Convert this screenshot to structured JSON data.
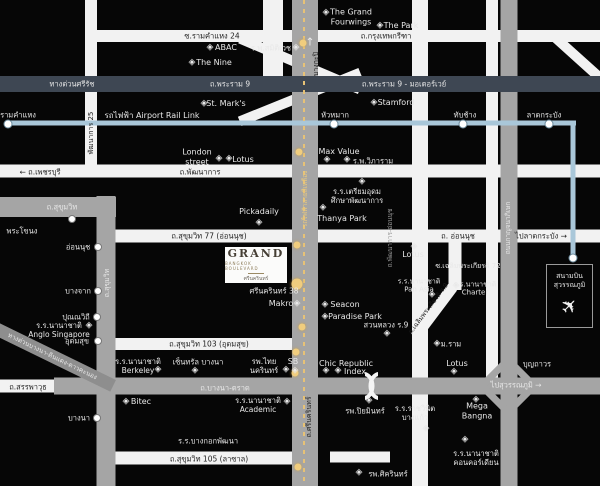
{
  "colors": {
    "background": "#060606",
    "road_white": "#f2f2f2",
    "road_gray": "#a5a5a5",
    "road_dark_expressway": "#3e4753",
    "airport_rail_link_blue": "#a9c7d9",
    "yellow_line": "#e7c276",
    "gold_station": "#f0cd7e",
    "label_white": "#e8e8e8",
    "label_dark": "#1c1c1c",
    "logo_brown": "#453e34"
  },
  "poi_glyph": "◈",
  "logo": {
    "title": "GRAND",
    "subtitle": "BANGKOK BOULEVARD",
    "thai": "ศรีนครินทร์"
  },
  "airport": {
    "name": "สนามบิน\nสุวรรณภูมิ",
    "icon": "airplane-icon"
  },
  "roads": [
    {
      "n": "road-ramkhamhaeng24-krungthepkreetha",
      "k": "white",
      "x": 344,
      "y": 36,
      "w": 512,
      "h": 12
    },
    {
      "n": "road-rama9-expressway",
      "k": "dark",
      "x": 300,
      "y": 84,
      "w": 600,
      "h": 16
    },
    {
      "n": "road-phatthanakan25",
      "k": "white",
      "x": 91,
      "y": 84,
      "w": 12,
      "h": 168
    },
    {
      "n": "road-phetchaburi-phatthanakan",
      "k": "white",
      "x": 300,
      "y": 171,
      "w": 600,
      "h": 13
    },
    {
      "n": "road-sukhumvit-horizontal",
      "k": "gray",
      "x": 58,
      "y": 207,
      "w": 116,
      "h": 20
    },
    {
      "n": "road-sukhumvit-vertical",
      "k": "gray",
      "x": 106,
      "y": 341,
      "w": 19,
      "h": 290
    },
    {
      "n": "road-onnut-sukhumvit77",
      "k": "white",
      "x": 356,
      "y": 236,
      "w": 488,
      "h": 13
    },
    {
      "n": "road-sukhumvit103",
      "k": "white",
      "x": 204,
      "y": 344,
      "w": 184,
      "h": 12
    },
    {
      "n": "road-bangna-trad",
      "k": "gray",
      "x": 327,
      "y": 386,
      "w": 546,
      "h": 17
    },
    {
      "n": "road-sanphawut",
      "k": "white",
      "x": 28,
      "y": 386,
      "w": 57,
      "h": 13
    },
    {
      "n": "road-expressway-bangna-diagonal",
      "k": "dgray",
      "x": 52,
      "y": 356,
      "w": 136,
      "h": 13,
      "r": 26
    },
    {
      "n": "road-sukhumvit105",
      "k": "white",
      "x": 204,
      "y": 458,
      "w": 184,
      "h": 13
    },
    {
      "n": "road-lasalle-east-segment",
      "k": "white",
      "x": 360,
      "y": 457,
      "w": 60,
      "h": 11
    },
    {
      "n": "road-srinakarin",
      "k": "gray",
      "x": 305,
      "y": 243,
      "w": 26,
      "h": 486
    },
    {
      "n": "road-chalermprakiat-r9-vertical",
      "k": "white",
      "x": 420,
      "y": 243,
      "w": 16,
      "h": 486
    },
    {
      "n": "road-soi-chalermprakiat72",
      "k": "white",
      "x": 455,
      "y": 266,
      "w": 13,
      "h": 48
    },
    {
      "n": "road-chalermprakiat-diagonal",
      "k": "white",
      "x": 434,
      "y": 312,
      "w": 62,
      "h": 11,
      "r": -53
    },
    {
      "n": "road-kanchanaphisek-west",
      "k": "white",
      "x": 492,
      "y": 189,
      "w": 12,
      "h": 378
    },
    {
      "n": "road-kanchanaphisek",
      "k": "gray",
      "x": 509,
      "y": 243,
      "w": 17,
      "h": 486
    },
    {
      "n": "road-top-center-stub",
      "k": "white",
      "x": 273,
      "y": 40,
      "w": 20,
      "h": 80
    },
    {
      "n": "road-ramp-upper",
      "k": "white",
      "x": 300,
      "y": 64,
      "w": 130,
      "h": 10,
      "r": 23,
      "z": 1
    },
    {
      "n": "road-ramp-lower",
      "k": "white",
      "x": 300,
      "y": 97,
      "w": 130,
      "h": 10,
      "r": -22,
      "z": 1
    },
    {
      "n": "road-ramp-topright",
      "k": "white",
      "x": 579,
      "y": 59,
      "w": 64,
      "h": 10,
      "r": 42,
      "z": 1
    },
    {
      "n": "rail-airport-link-horizontal",
      "k": "arl",
      "x": 291,
      "y": 123,
      "w": 570,
      "h": 5
    },
    {
      "n": "rail-airport-link-branch",
      "k": "arl",
      "x": 573,
      "y": 191,
      "w": 5,
      "h": 136
    },
    {
      "n": "rail-yellow-line",
      "k": "ydash",
      "x": 304,
      "y": 243,
      "w": 2,
      "h": 486
    }
  ],
  "labels": [
    {
      "n": "soi-ramkhamhaeng24-label",
      "t": "ซ.รามคำแหง 24",
      "x": 212,
      "y": 36,
      "c": "d",
      "s": 7.5
    },
    {
      "n": "krungthep-kreetha-label",
      "t": "ถ.กรุงเทพกรีฑา",
      "x": 386,
      "y": 36,
      "c": "d",
      "s": 7.5
    },
    {
      "n": "expressway-sirat-label",
      "t": "ทางด่วนศรีรัช",
      "x": 72,
      "y": 84,
      "c": "w",
      "s": 7.5
    },
    {
      "n": "rama9-label",
      "t": "ถ.พระราม 9",
      "x": 230,
      "y": 84,
      "c": "w",
      "s": 7.5
    },
    {
      "n": "rama9-motorway-label",
      "t": "ถ.พระราม 9 - มอเตอร์เวย์",
      "x": 404,
      "y": 84,
      "c": "w",
      "s": 7.5
    },
    {
      "n": "grand-fourwings-label",
      "t": "The Grand\nFourwings",
      "x": 351,
      "y": 17,
      "c": "w",
      "s": 8
    },
    {
      "n": "the-park-label",
      "t": "The Park",
      "x": 401,
      "y": 26,
      "c": "w",
      "s": 8
    },
    {
      "n": "abac-label",
      "t": "ABAC",
      "x": 226,
      "y": 48,
      "c": "w",
      "s": 8
    },
    {
      "n": "samitivej-hospital-label",
      "t": "ร.พ.สมิติเวช",
      "x": 271,
      "y": 48,
      "c": "w",
      "s": 7.5
    },
    {
      "n": "the-nine-label",
      "t": "The Nine",
      "x": 214,
      "y": 63,
      "c": "w",
      "s": 8
    },
    {
      "n": "st-marks-label",
      "t": "St. Mark's",
      "x": 226,
      "y": 104,
      "c": "w",
      "s": 8
    },
    {
      "n": "stamford-label",
      "t": "Stamford",
      "x": 396,
      "y": 103,
      "c": "w",
      "s": 8
    },
    {
      "n": "ramkhamhaeng-station-label",
      "t": "รามคำแหง",
      "x": 18,
      "y": 115,
      "c": "w",
      "s": 7.5
    },
    {
      "n": "airport-rail-link-label",
      "t": "รถไฟฟ้า Airport Rail Link",
      "x": 152,
      "y": 116,
      "c": "w",
      "s": 8
    },
    {
      "n": "huamak-station-label",
      "t": "หัวหมาก",
      "x": 335,
      "y": 115,
      "c": "w",
      "s": 7.5
    },
    {
      "n": "thapchang-station-label",
      "t": "ทับช้าง",
      "x": 465,
      "y": 115,
      "c": "w",
      "s": 7.5
    },
    {
      "n": "latkrabang-station-label",
      "t": "ลาดกระบัง",
      "x": 544,
      "y": 115,
      "c": "w",
      "s": 7.5
    },
    {
      "n": "phetchaburi-road-label",
      "t": "← ถ.เพชรบุรี",
      "x": 40,
      "y": 172,
      "c": "d",
      "s": 7.5
    },
    {
      "n": "phatthanakan-road-label",
      "t": "ถ.พัฒนาการ",
      "x": 200,
      "y": 172,
      "c": "d",
      "s": 7.5
    },
    {
      "n": "phatthanakan25-label",
      "t": "พัฒนาการ 25",
      "x": 91,
      "y": 133,
      "c": "d",
      "s": 7,
      "r": -90
    },
    {
      "n": "london-street-label",
      "t": "London\nstreet",
      "x": 197,
      "y": 157,
      "c": "w",
      "s": 8
    },
    {
      "n": "lotus-phatthanakan-label",
      "t": "Lotus",
      "x": 243,
      "y": 160,
      "c": "w",
      "s": 8
    },
    {
      "n": "max-value-label",
      "t": "Max Value",
      "x": 339,
      "y": 152,
      "c": "w",
      "s": 8
    },
    {
      "n": "vibharam-hospital-label",
      "t": "ร.พ.วิภาราม",
      "x": 373,
      "y": 161,
      "c": "w",
      "s": 7.5
    },
    {
      "n": "sukhumvit-road-label",
      "t": "ถ.สุขุมวิท",
      "x": 62,
      "y": 207,
      "c": "w",
      "s": 7.5
    },
    {
      "n": "sukhumvit-road-label-vertical",
      "t": "ถ.สุขุมวิท",
      "x": 107,
      "y": 283,
      "c": "w",
      "s": 7,
      "r": -90
    },
    {
      "n": "phrakanong-station-label",
      "t": "พระโขนง",
      "x": 22,
      "y": 231,
      "c": "w",
      "s": 7.5
    },
    {
      "n": "onnut-station-label",
      "t": "อ่อนนุช",
      "x": 78,
      "y": 247,
      "c": "w",
      "s": 7.5
    },
    {
      "n": "bangchak-station-label",
      "t": "บางจาก",
      "x": 78,
      "y": 291,
      "c": "w",
      "s": 7.5
    },
    {
      "n": "punnawithi-station-label",
      "t": "ปุณณวิถี",
      "x": 76,
      "y": 317,
      "c": "w",
      "s": 7.5
    },
    {
      "n": "udomsuk-station-label",
      "t": "อุดมสุข",
      "x": 77,
      "y": 341,
      "c": "w",
      "s": 7.5
    },
    {
      "n": "bangna-station-label",
      "t": "บางนา",
      "x": 79,
      "y": 418,
      "c": "w",
      "s": 7.5
    },
    {
      "n": "pickadaily-label",
      "t": "Pickadaily",
      "x": 259,
      "y": 212,
      "c": "w",
      "s": 8
    },
    {
      "n": "triamudom-school-label",
      "t": "ร.ร.เตรียมอุดม\nศึกษาพัฒนาการ",
      "x": 357,
      "y": 196,
      "c": "w",
      "s": 7.5
    },
    {
      "n": "thanya-park-label",
      "t": "Thanya Park",
      "x": 342,
      "y": 219,
      "c": "w",
      "s": 8
    },
    {
      "n": "sukhumvit77-road-label",
      "t": "ถ.สุขุมวิท 77 (อ่อนนุช)",
      "x": 209,
      "y": 236,
      "c": "d",
      "s": 7.5
    },
    {
      "n": "onnut-road-label",
      "t": "ถ. อ่อนนุช",
      "x": 458,
      "y": 236,
      "c": "d",
      "s": 7.5
    },
    {
      "n": "to-latkrabang-label",
      "t": "ไปลาดกระบัง →",
      "x": 541,
      "y": 236,
      "c": "d",
      "s": 7.5
    },
    {
      "n": "bangkapi-label",
      "t": "บางกะปิ",
      "x": 316,
      "y": 64,
      "c": "d",
      "s": 7,
      "r": -90
    },
    {
      "n": "srinakarin-north-arrow",
      "t": "↑",
      "x": 310,
      "y": 42,
      "c": "w",
      "s": 11
    },
    {
      "n": "yellow-line-label",
      "t": "รถไฟฟ้าสายสีเหลือง",
      "x": 306,
      "y": 199,
      "c": "g",
      "s": 6.5,
      "r": -90
    },
    {
      "n": "srinakarin-road-label",
      "t": "ถ.ศรีนครินทร์",
      "x": 309,
      "y": 417,
      "c": "d",
      "s": 7,
      "r": -90
    },
    {
      "n": "srinakarin38-label",
      "t": "ศรีนครินทร์ 38",
      "x": 274,
      "y": 291,
      "c": "w",
      "s": 7.5
    },
    {
      "n": "makro-label",
      "t": "Makro",
      "x": 281,
      "y": 304,
      "c": "w",
      "s": 8
    },
    {
      "n": "seacon-label",
      "t": "Seacon",
      "x": 345,
      "y": 305,
      "c": "w",
      "s": 8
    },
    {
      "n": "paradise-park-label",
      "t": "Paradise Park",
      "x": 355,
      "y": 317,
      "c": "w",
      "s": 8
    },
    {
      "n": "suan-luang-r9-label",
      "t": "สวนหลวง ร.9",
      "x": 386,
      "y": 325,
      "c": "w",
      "s": 7.5
    },
    {
      "n": "ram-university-label",
      "t": "ม.ราม",
      "x": 451,
      "y": 344,
      "c": "w",
      "s": 7.5
    },
    {
      "n": "lotus-onnut-label",
      "t": "Lotus",
      "x": 457,
      "y": 364,
      "c": "w",
      "s": 8
    },
    {
      "n": "boonthavorn-label",
      "t": "บุญถาวร",
      "x": 537,
      "y": 364,
      "c": "w",
      "s": 7.5
    },
    {
      "n": "to-suvarnabhumi-label",
      "t": "ไปสุวรรณภูมิ →",
      "x": 516,
      "y": 385,
      "c": "w",
      "s": 7.5
    },
    {
      "n": "bangna-trad-road-label",
      "t": "ถ.บางนา-ตราด",
      "x": 225,
      "y": 388,
      "c": "w",
      "s": 7.5
    },
    {
      "n": "sanphawut-road-label",
      "t": "ถ.สรรพาวุธ",
      "x": 28,
      "y": 387,
      "c": "d",
      "s": 7.5
    },
    {
      "n": "expressway-bangna-label",
      "t": "ทางด่วนบางนา-ดินแดง-ดาวคะนอง",
      "x": 52,
      "y": 357,
      "c": "w",
      "s": 6.5,
      "r": 26
    },
    {
      "n": "sukhumvit103-road-label",
      "t": "ถ.สุขุมวิท 103 (อุดมสุข)",
      "x": 209,
      "y": 344,
      "c": "d",
      "s": 7.5
    },
    {
      "n": "anglo-singapore-school-label",
      "t": "ร.ร.นานาชาติ\nAnglo Singapore",
      "x": 59,
      "y": 330,
      "c": "w",
      "s": 7.5
    },
    {
      "n": "berkeley-school-label",
      "t": "ร.ร.นานาชาติ\nBerkeley",
      "x": 138,
      "y": 366,
      "c": "w",
      "s": 7.5
    },
    {
      "n": "central-bangna-label",
      "t": "เซ็นทรัล บางนา",
      "x": 198,
      "y": 362,
      "c": "w",
      "s": 7.5
    },
    {
      "n": "thai-nakarin-hospital-label",
      "t": "รพ.ไทย\nนครินทร์",
      "x": 264,
      "y": 366,
      "c": "w",
      "s": 7.5
    },
    {
      "n": "sb-label",
      "t": "SB",
      "x": 293,
      "y": 362,
      "c": "w",
      "s": 8
    },
    {
      "n": "chic-republic-label",
      "t": "Chic Republic",
      "x": 346,
      "y": 364,
      "c": "w",
      "s": 8
    },
    {
      "n": "index-label",
      "t": "Index",
      "x": 355,
      "y": 372,
      "c": "w",
      "s": 8
    },
    {
      "n": "bitec-label",
      "t": "Bitec",
      "x": 141,
      "y": 402,
      "c": "w",
      "s": 8
    },
    {
      "n": "academic-school-label",
      "t": "ร.ร.นานาชาติ\nAcademic",
      "x": 258,
      "y": 405,
      "c": "w",
      "s": 7.5
    },
    {
      "n": "bangkok-pattana-school-label",
      "t": "ร.ร.บางกอกพัฒนา",
      "x": 208,
      "y": 441,
      "c": "w",
      "s": 7.5
    },
    {
      "n": "sukhumvit105-road-label",
      "t": "ถ.สุขุมวิท 105 (ลาซาล)",
      "x": 209,
      "y": 459,
      "c": "d",
      "s": 7.5
    },
    {
      "n": "sikarin-hospital-label",
      "t": "รพ.ศิครินทร์",
      "x": 388,
      "y": 474,
      "c": "w",
      "s": 7.5
    },
    {
      "n": "piyamin-hospital-label",
      "t": "รพ.ปิยมินทร์",
      "x": 365,
      "y": 411,
      "c": "w",
      "s": 7.5
    },
    {
      "n": "rajvinit-bangkaew-school-label",
      "t": "ร.ร.ราชวินิต\nบางแก้ว",
      "x": 415,
      "y": 413,
      "c": "w",
      "s": 7.5
    },
    {
      "n": "mega-bangna-label",
      "t": "Mega\nBangna",
      "x": 477,
      "y": 411,
      "c": "w",
      "s": 8
    },
    {
      "n": "concordian-school-label",
      "t": "ร.ร.นานาชาติ\nคอนคอร์เดียน",
      "x": 476,
      "y": 458,
      "c": "w",
      "s": 7.5
    },
    {
      "n": "soi-chalermprakiat72-label",
      "t": "ซ.เฉลิมพระเกียรติ 72",
      "x": 468,
      "y": 266,
      "c": "w",
      "s": 7
    },
    {
      "n": "pan-asia-school-label",
      "t": "ร.ร.นานาชาติ\nPan Asia",
      "x": 419,
      "y": 286,
      "c": "w",
      "s": 7
    },
    {
      "n": "charter-school-label",
      "t": "ร.ร.นานาชาติ\nCharter",
      "x": 475,
      "y": 289,
      "c": "w",
      "s": 7
    },
    {
      "n": "lotus-center-label",
      "t": "Lotus",
      "x": 413,
      "y": 255,
      "c": "w",
      "s": 8
    },
    {
      "n": "chalermprakiat-r9-road-label",
      "t": "ถ.เฉลิมพระเกียรติ ร.9",
      "x": 429,
      "y": 309,
      "c": "d",
      "s": 6.5,
      "r": -53
    },
    {
      "n": "phatthanakan-onnut-road-label",
      "t": "ถ.พัฒนาการ-อ่อนนุช",
      "x": 391,
      "y": 238,
      "c": "m",
      "s": 6.5,
      "r": -90
    },
    {
      "n": "kanchanaphisek-road-label",
      "t": "ถนนกาญจนาภิเษก",
      "x": 509,
      "y": 228,
      "c": "w",
      "s": 6.5,
      "r": -90
    }
  ],
  "pois": [
    {
      "n": "grand-fourwings-icon",
      "x": 326,
      "y": 13
    },
    {
      "n": "the-park-icon",
      "x": 380,
      "y": 26
    },
    {
      "n": "abac-icon",
      "x": 210,
      "y": 48
    },
    {
      "n": "samitivej-icon",
      "x": 296,
      "y": 48
    },
    {
      "n": "the-nine-icon",
      "x": 192,
      "y": 63
    },
    {
      "n": "st-marks-icon",
      "x": 204,
      "y": 104
    },
    {
      "n": "stamford-icon",
      "x": 374,
      "y": 103
    },
    {
      "n": "london-lotus-icon-1",
      "x": 219,
      "y": 159
    },
    {
      "n": "london-lotus-icon-2",
      "x": 229,
      "y": 159
    },
    {
      "n": "max-value-icon",
      "x": 327,
      "y": 160
    },
    {
      "n": "vibharam-icon",
      "x": 347,
      "y": 160
    },
    {
      "n": "pickadaily-icon",
      "x": 259,
      "y": 223
    },
    {
      "n": "triamudom-icon",
      "x": 362,
      "y": 182
    },
    {
      "n": "thanya-park-icon",
      "x": 323,
      "y": 208
    },
    {
      "n": "makro-icon",
      "x": 297,
      "y": 304
    },
    {
      "n": "seacon-icon",
      "x": 325,
      "y": 305
    },
    {
      "n": "paradise-park-icon",
      "x": 325,
      "y": 317
    },
    {
      "n": "suan-luang-icon",
      "x": 387,
      "y": 334
    },
    {
      "n": "ram-university-icon",
      "x": 437,
      "y": 344
    },
    {
      "n": "lotus-center-icon",
      "x": 414,
      "y": 247
    },
    {
      "n": "pan-asia-icon",
      "x": 432,
      "y": 295
    },
    {
      "n": "charter-icon",
      "x": 456,
      "y": 286
    },
    {
      "n": "lotus-onnut-icon",
      "x": 454,
      "y": 372
    },
    {
      "n": "chic-republic-icon-1",
      "x": 326,
      "y": 371
    },
    {
      "n": "chic-republic-icon-2",
      "x": 338,
      "y": 371
    },
    {
      "n": "sb-icon",
      "x": 295,
      "y": 371
    },
    {
      "n": "thai-nakarin-icon",
      "x": 286,
      "y": 370
    },
    {
      "n": "berkeley-icon",
      "x": 158,
      "y": 370
    },
    {
      "n": "central-bangna-icon",
      "x": 195,
      "y": 371
    },
    {
      "n": "anglo-singapore-icon",
      "x": 89,
      "y": 326
    },
    {
      "n": "bitec-icon",
      "x": 126,
      "y": 402
    },
    {
      "n": "academic-icon",
      "x": 287,
      "y": 402
    },
    {
      "n": "mega-bangna-icon",
      "x": 476,
      "y": 400
    },
    {
      "n": "piyamin-icon",
      "x": 369,
      "y": 401
    },
    {
      "n": "rajvinit-icon",
      "x": 426,
      "y": 429
    },
    {
      "n": "concordian-icon",
      "x": 465,
      "y": 440
    },
    {
      "n": "sikarin-icon",
      "x": 359,
      "y": 473
    }
  ],
  "stations": {
    "arl": [
      {
        "n": "arl-ramkhamhaeng-dot",
        "x": 8,
        "y": 124
      },
      {
        "n": "arl-huamak-dot",
        "x": 334,
        "y": 124
      },
      {
        "n": "arl-thapchang-dot",
        "x": 463,
        "y": 124
      },
      {
        "n": "arl-latkrabang-dot",
        "x": 549,
        "y": 124
      },
      {
        "n": "arl-suvarnabhumi-dot",
        "x": 573,
        "y": 258
      }
    ],
    "bts": [
      {
        "n": "bts-phrakanong-dot",
        "x": 72,
        "y": 219
      },
      {
        "n": "bts-onnut-dot",
        "x": 98,
        "y": 247
      },
      {
        "n": "bts-bangchak-dot",
        "x": 98,
        "y": 291
      },
      {
        "n": "bts-punnawithi-dot",
        "x": 97,
        "y": 317
      },
      {
        "n": "bts-udomsuk-dot",
        "x": 98,
        "y": 341
      },
      {
        "n": "bts-bangna-dot",
        "x": 97,
        "y": 418
      }
    ],
    "yellow": [
      {
        "n": "yellow-station-dot-1",
        "x": 303,
        "y": 43
      },
      {
        "n": "yellow-station-dot-2",
        "x": 299,
        "y": 152
      },
      {
        "n": "yellow-station-dot-3",
        "x": 297,
        "y": 245
      },
      {
        "n": "yellow-station-project-dot",
        "x": 297,
        "y": 284,
        "big": true
      },
      {
        "n": "yellow-station-dot-5",
        "x": 302,
        "y": 327
      },
      {
        "n": "yellow-station-dot-6",
        "x": 296,
        "y": 352
      },
      {
        "n": "yellow-station-dot-7",
        "x": 295,
        "y": 373
      },
      {
        "n": "yellow-station-dot-8",
        "x": 298,
        "y": 467
      }
    ]
  }
}
